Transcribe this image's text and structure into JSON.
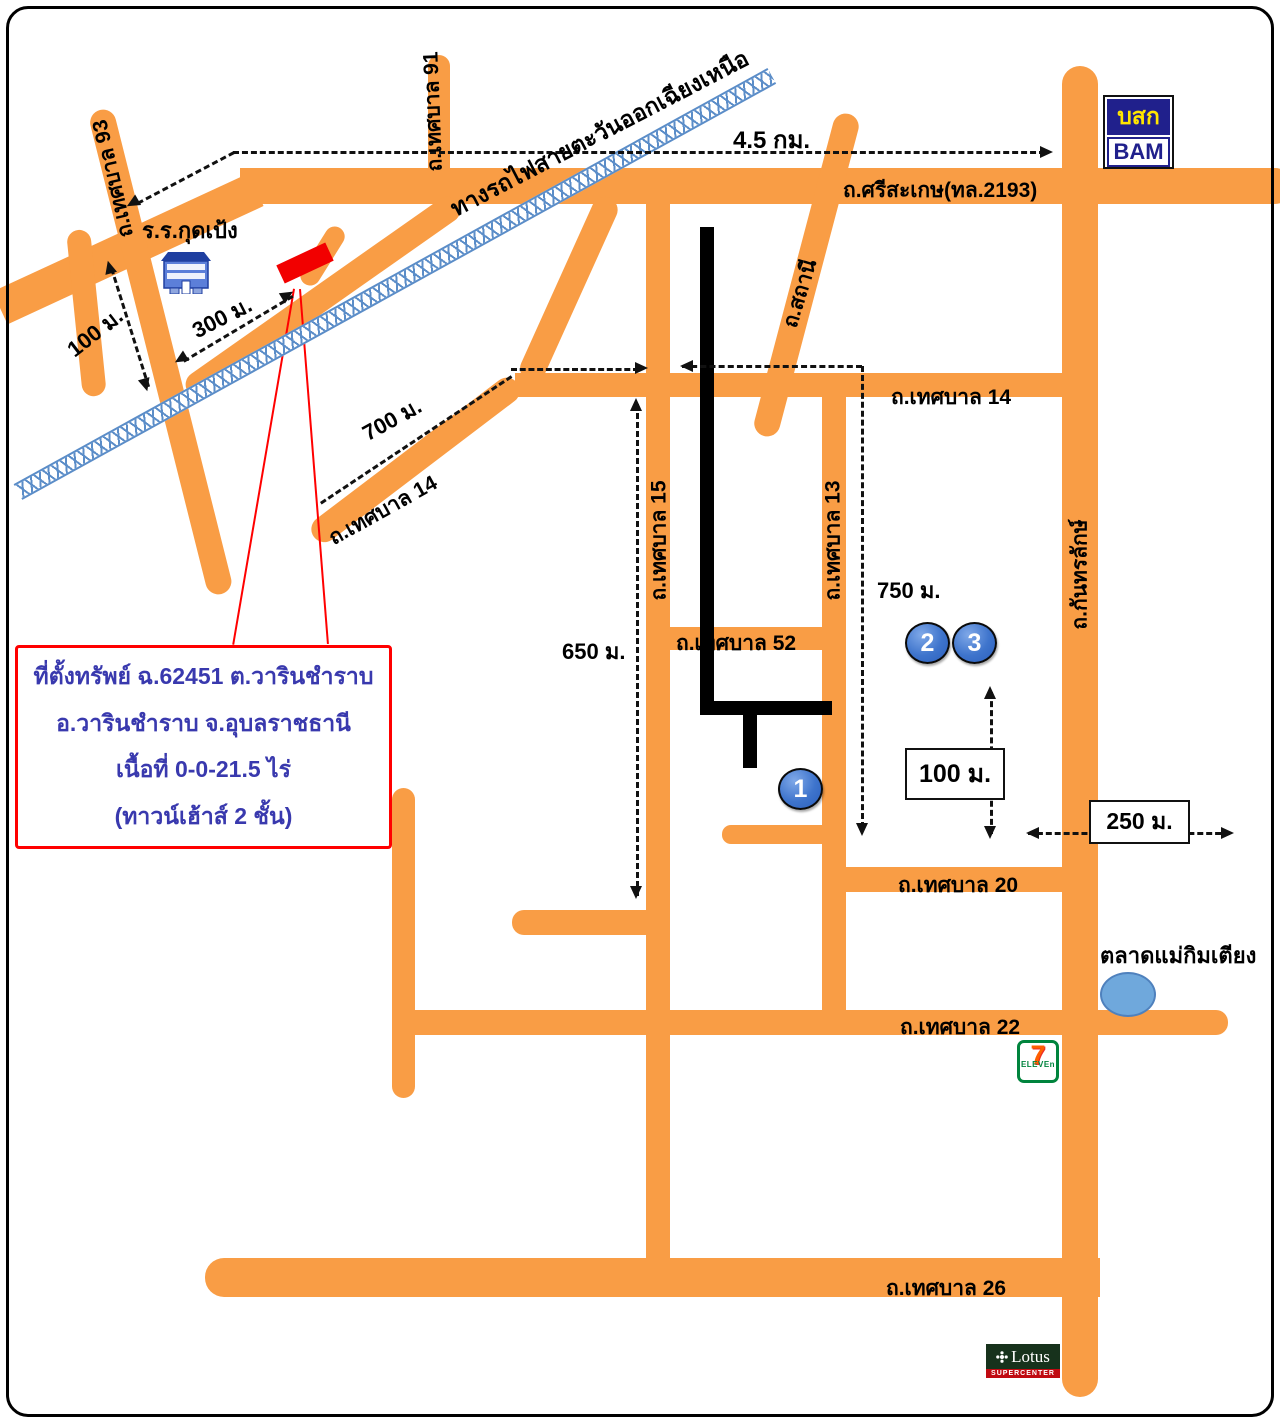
{
  "colors": {
    "road": "#F99D45",
    "railway": "#5B8DC8",
    "accent_red": "#FF0000",
    "property_text_blue": "#3939AE",
    "marker_blue": "#2B5FBD",
    "bam_navy": "#20208C",
    "bam_yellow": "#FFE600"
  },
  "roads": {
    "sisaket": "ถ.ศรีสะเกษ(ทล.2193)",
    "tesaban_91": "ถ.เทศบาล 91",
    "tesaban_93": "ถ.เทศบาล 93",
    "tesaban_14_west": "ถ.เทศบาล 14",
    "tesaban_14_east": "ถ.เทศบาล 14",
    "tesaban_15": "ถ.เทศบาล 15",
    "tesaban_13": "ถ.เทศบาล 13",
    "tesaban_52": "ถ.เทศบาล 52",
    "tesaban_20": "ถ.เทศบาล 20",
    "tesaban_22": "ถ.เทศบาล 22",
    "tesaban_26": "ถ.เทศบาล 26",
    "sathani": "ถ.สถานี",
    "kantharalak": "ถ.กันทรลักษ์",
    "railway": "ทางรถไฟสายตะวันออกเฉียงเหนือ"
  },
  "distances": {
    "d45km": "4.5 กม.",
    "d100_school": "100 ม.",
    "d300": "300 ม.",
    "d700": "700 ม.",
    "d650": "650 ม.",
    "d750": "750 ม.",
    "d100_box": "100 ม.",
    "d250_box": "250 ม."
  },
  "places": {
    "school": "ร.ร.กุดเป้ง",
    "market": "ตลาดแม่กิมเตียง"
  },
  "property_box": {
    "line1": "ที่ตั้งทรัพย์ ฉ.62451 ต.วารินชำราบ",
    "line2": "อ.วารินชำราบ  จ.อุบลราชธานี",
    "line3": "เนื้อที่ 0-0-21.5 ไร่",
    "line4": "(ทาวน์เฮ้าส์ 2 ชั้น)"
  },
  "markers": {
    "m1": "1",
    "m2": "2",
    "m3": "3"
  },
  "logos": {
    "bam_thai": "บสก",
    "bam_en": "BAM",
    "seven": "7",
    "seven_sub": "ELEVEn",
    "lotus": "Lotus",
    "lotus_sub": "SUPERCENTER"
  }
}
